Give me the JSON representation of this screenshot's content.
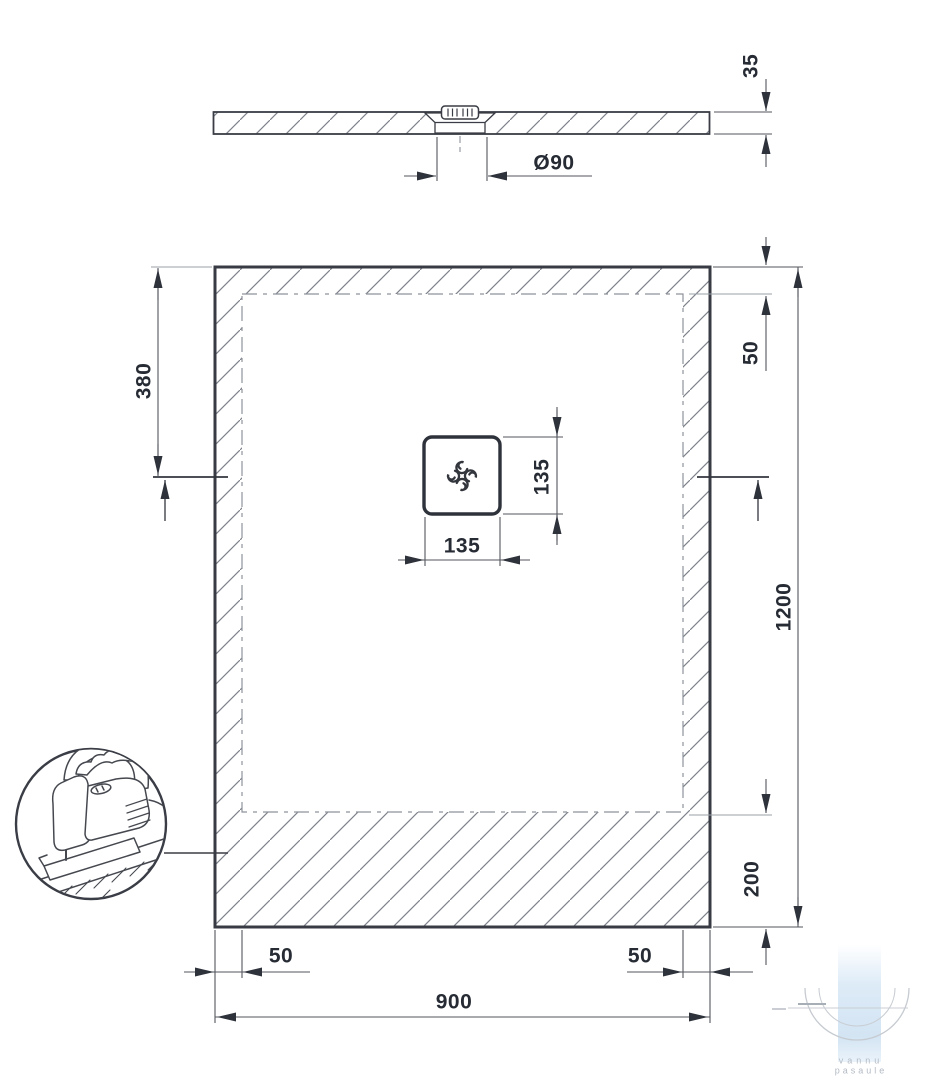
{
  "side_view": {
    "thickness_mm": "35",
    "drain_diameter": "Ø90"
  },
  "plan_view": {
    "overall_width_mm": "900",
    "overall_length_mm": "1200",
    "drain_center_from_top_mm": "380",
    "top_edge_band_mm": "50",
    "bottom_edge_band_mm": "200",
    "left_edge_band_mm": "50",
    "right_edge_band_mm": "50",
    "drain_square_width_mm": "135",
    "drain_square_height_mm": "135"
  },
  "watermark": {
    "brand_line1": "vannu",
    "brand_line2": "pasaule"
  },
  "colors": {
    "line_dark": "#3a3d45",
    "line_dim": "#53565e",
    "line_light": "#9aa0a7",
    "text": "#262b34",
    "watermark_blue": "#d7e7f5",
    "watermark_gray": "#b3bac4"
  }
}
